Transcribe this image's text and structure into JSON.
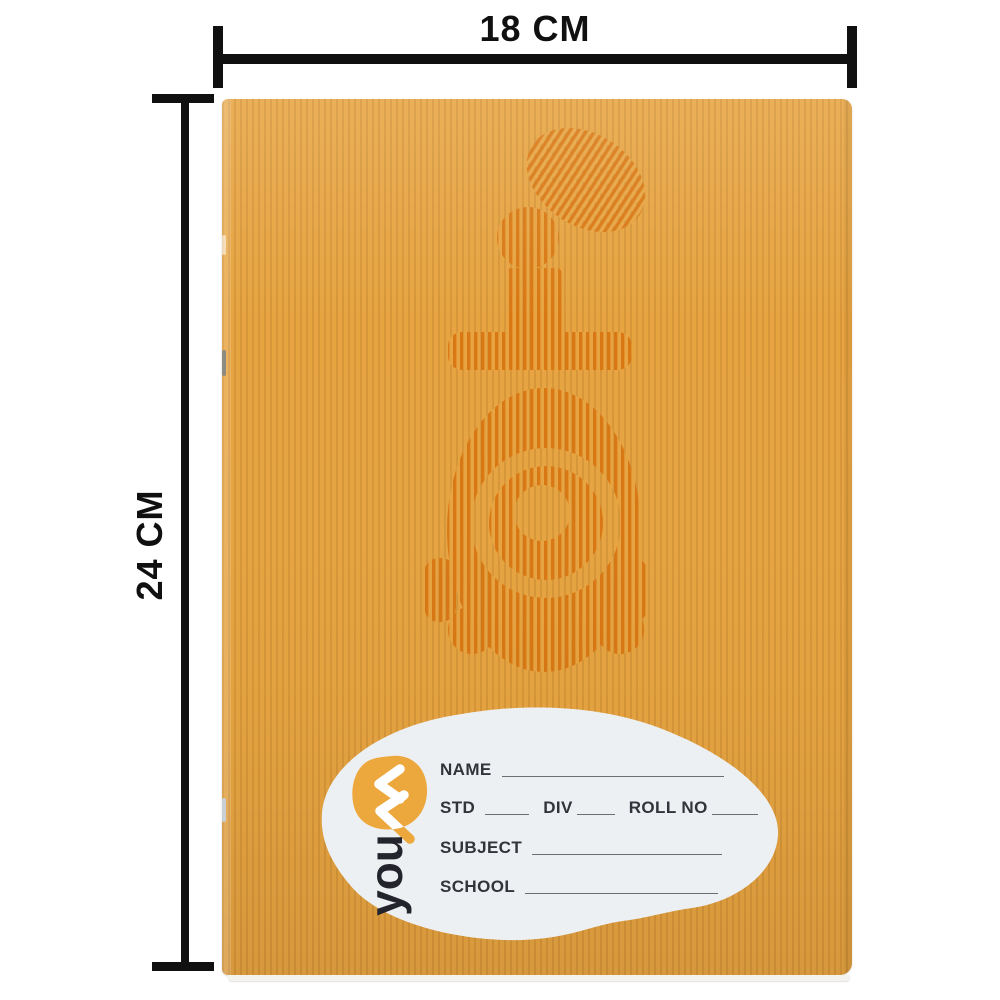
{
  "scene": {
    "description": "Orange pin-striped Youva school notebook (soft cover, stapled spine) photographed on white with size measurement annotations"
  },
  "dimensions": {
    "width_label": "18 CM",
    "height_label": "24 CM"
  },
  "brand": {
    "word": "you",
    "mark": "va-double-chevron"
  },
  "label_fields": {
    "name": "NAME",
    "std": "STD",
    "div": "DIV",
    "roll_no": "ROLL NO",
    "subject": "SUBJECT",
    "school": "SCHOOL"
  },
  "colors": {
    "cover_base": "#E7A441",
    "cover_stripe": "#C98A33",
    "watermark_stripe": "#D9750F",
    "label_bg": "#EDF0F3",
    "brand_blob": "#EDA83D",
    "brand_text": "#23242C",
    "field_text": "#31343A",
    "field_line": "#6A6D72",
    "ruler": "#101010",
    "pages_edge": "#F4F3EE",
    "staple_dark": "#8D8A7F",
    "staple_light": "#C9CFD2"
  }
}
